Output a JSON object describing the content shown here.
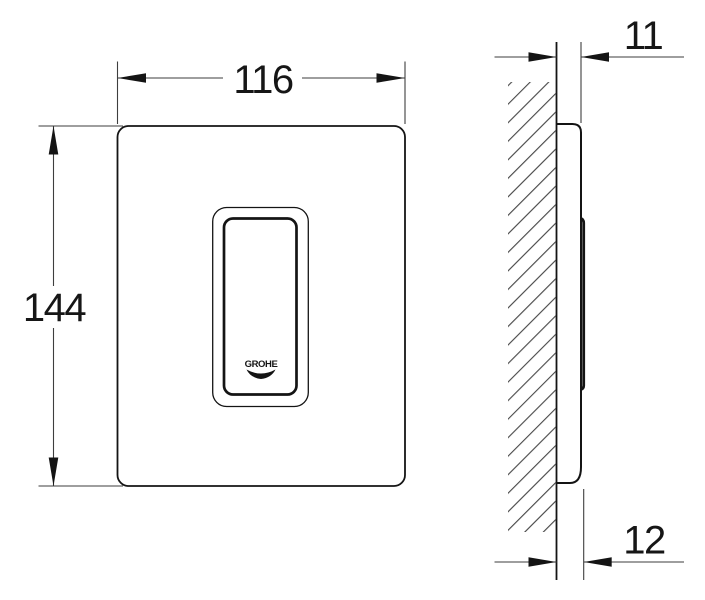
{
  "front_view": {
    "width_label": "116",
    "height_label": "144",
    "logo_text": "GROHE"
  },
  "side_view": {
    "plate_depth_label": "11",
    "button_depth_label": "12"
  },
  "colors": {
    "background": "#ffffff",
    "object_line": "#141414",
    "dimension_line": "#3e3e3e",
    "text": "#161616"
  }
}
